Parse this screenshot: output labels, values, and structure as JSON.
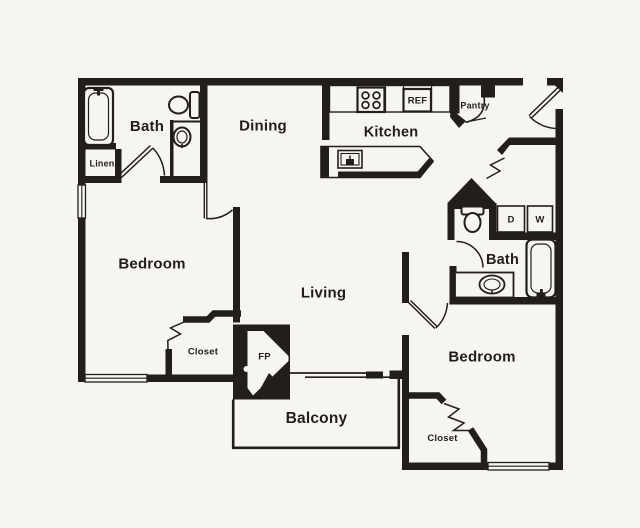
{
  "plan": {
    "type": "apartment-floor-plan",
    "labels": {
      "bath1": "Bath",
      "linen": "Linen",
      "dining": "Dining",
      "kitchen": "Kitchen",
      "pantry": "Pantry",
      "ref": "REF",
      "bedroom1": "Bedroom",
      "living": "Living",
      "closet1": "Closet",
      "fireplace": "FP",
      "balcony": "Balcony",
      "dryer": "D",
      "washer": "W",
      "bath2": "Bath",
      "bedroom2": "Bedroom",
      "closet2": "Closet"
    },
    "colors": {
      "ink": "#211e1b",
      "paper": "#f7f5f1"
    }
  }
}
